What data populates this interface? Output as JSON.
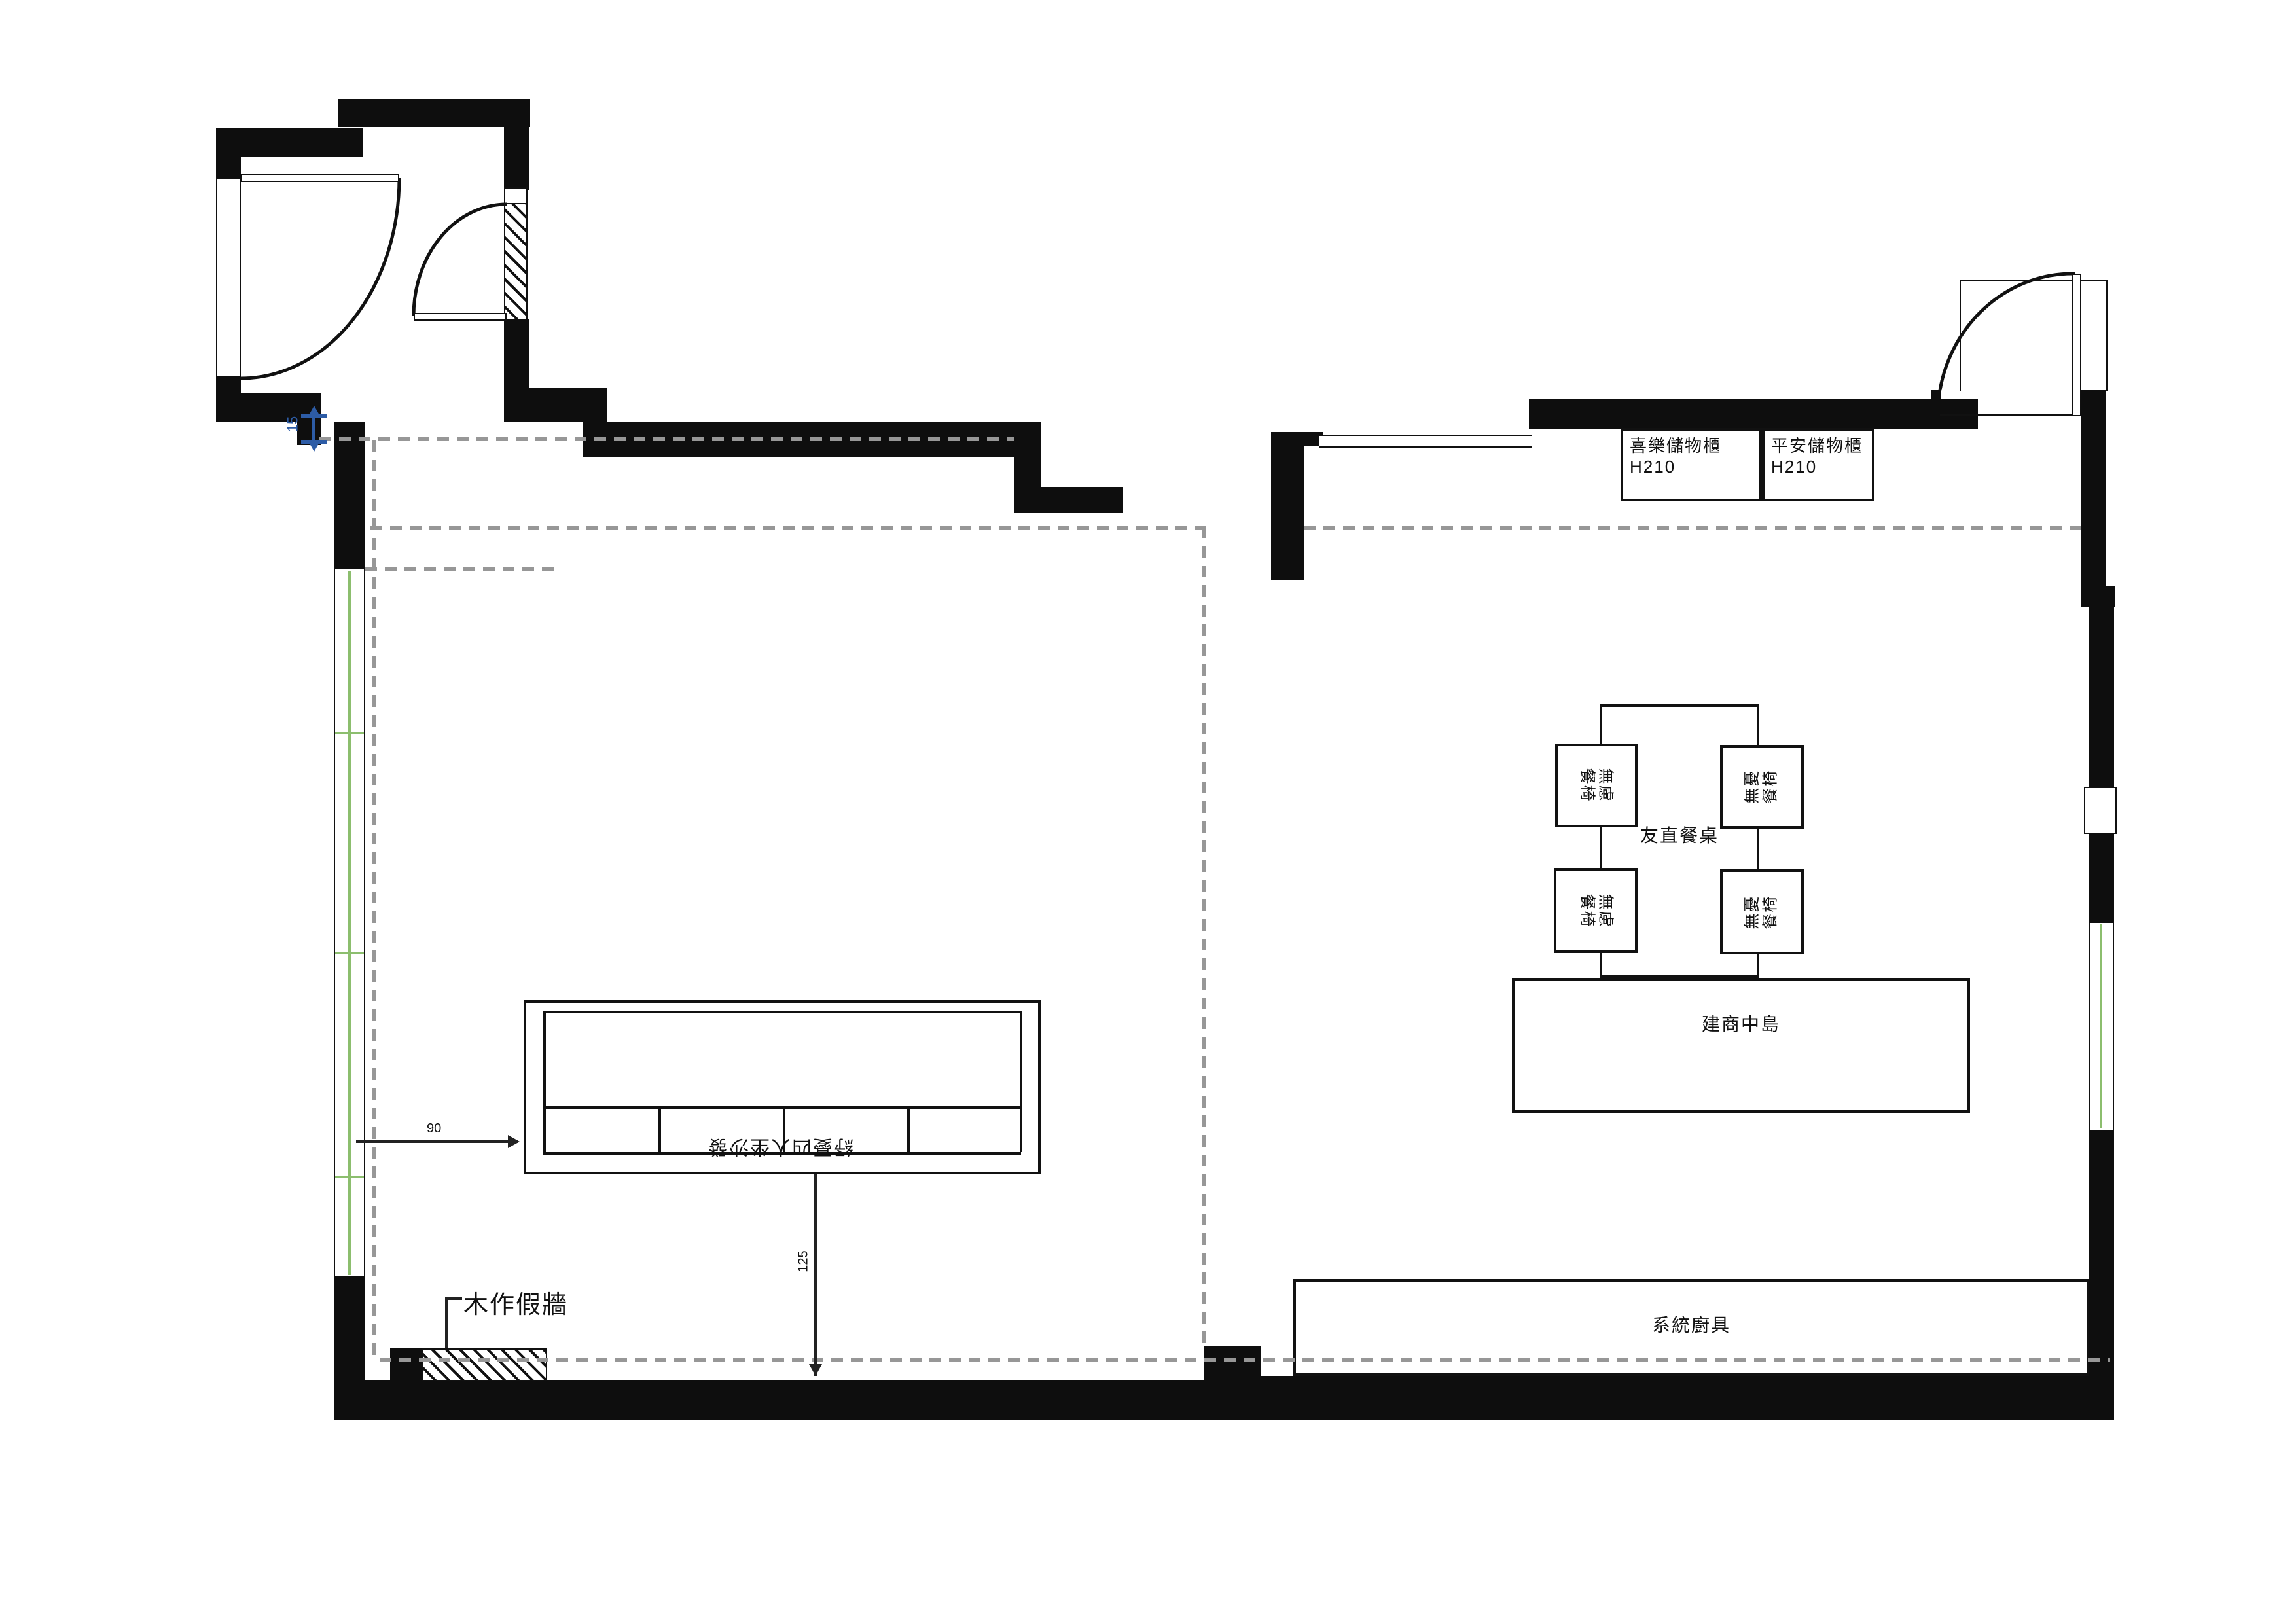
{
  "plan_title": "residential floor plan",
  "cabinets": {
    "cabinet1": {
      "name": "喜樂儲物櫃",
      "height": "H210"
    },
    "cabinet2": {
      "name": "平安儲物櫃",
      "height": "H210"
    }
  },
  "dining": {
    "table_label": "友直餐桌",
    "chairs": [
      {
        "line1": "無慮",
        "line2": "餐椅"
      },
      {
        "line1": "無憂",
        "line2": "餐椅"
      },
      {
        "line1": "無慮",
        "line2": "餐椅"
      },
      {
        "line1": "無憂",
        "line2": "餐椅"
      }
    ]
  },
  "kitchen": {
    "island_label": "建商中島",
    "counter_label": "系統廚具"
  },
  "living": {
    "sofa_label": "紓憂四人坐沙發",
    "false_wall_label": "木作假牆"
  },
  "dimensions": {
    "sofa_left_offset": "90",
    "sofa_to_wall": "125",
    "wall_step": "15"
  },
  "colors": {
    "wall": "#0e0e0e",
    "window_green": "#8cbe6e",
    "dimension_blue": "#2d5ca6",
    "dashed_gray": "#979797"
  }
}
